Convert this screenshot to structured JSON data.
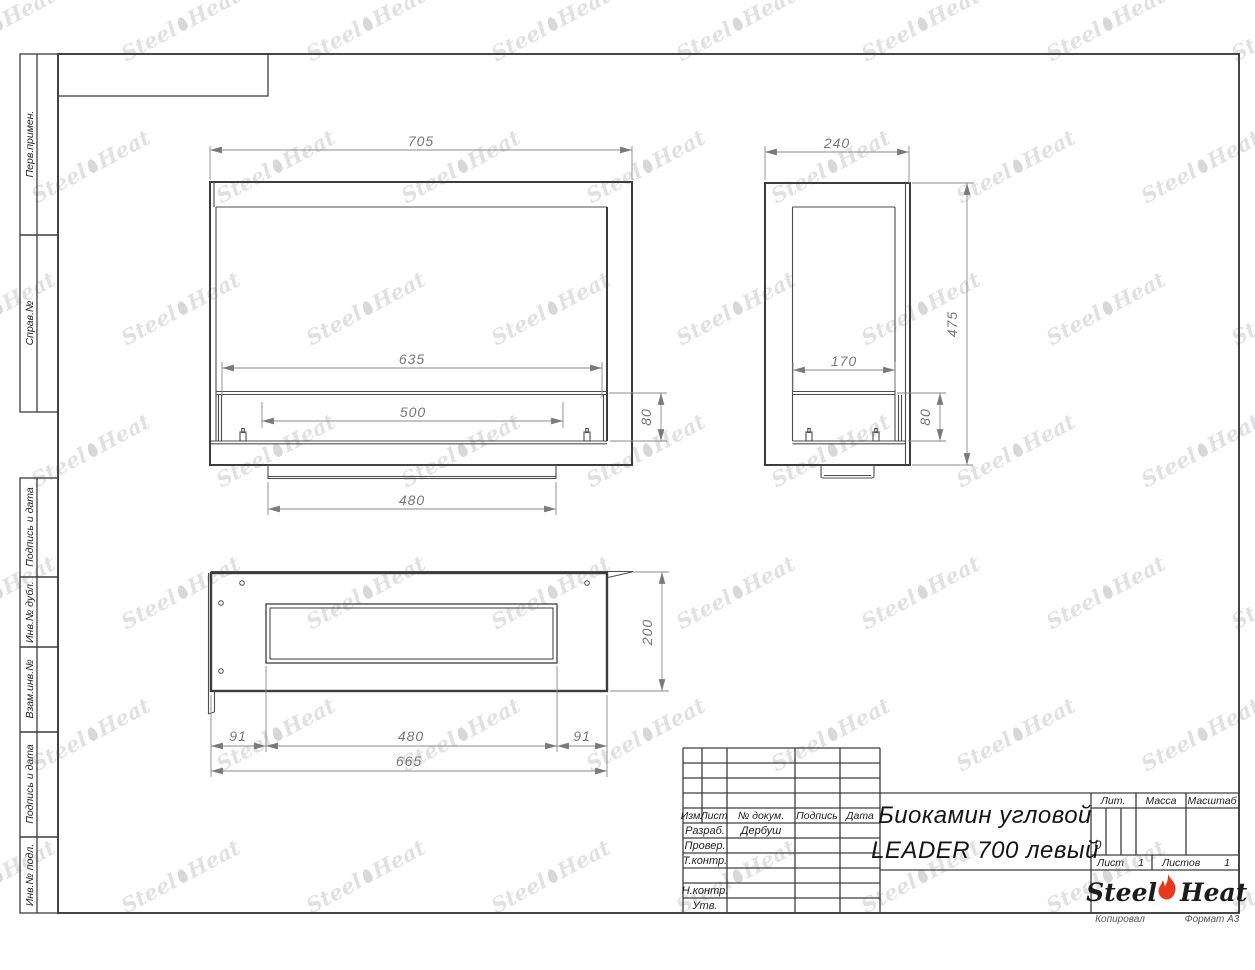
{
  "margin_labels": [
    "Перв.примен.",
    "Справ.№",
    "Подпись и дата",
    "Инв.№ дубл.",
    "Взам.инв.№",
    "Подпись и дата",
    "Инв.№ подл."
  ],
  "title_block": {
    "cols": {
      "izm": "Изм.",
      "list": "Лист",
      "doc": "№ докум.",
      "sign": "Подпись",
      "date": "Дата"
    },
    "rows": {
      "razrab": "Разраб.",
      "prover": "Провер.",
      "tkontr": "Т.контр.",
      "nkontr": "Н.контр.",
      "utv": "Утв."
    },
    "razrab_name": "Дербуш",
    "title_line1": "Биокамин угловой",
    "title_line2": "LEADER 700 левый",
    "lit_label": "Лит.",
    "lit_value": "0",
    "mass_label": "Масса",
    "scale_label": "Масштаб",
    "sheet_label": "Лист",
    "sheet_value": "1",
    "sheets_label": "Листов",
    "sheets_value": "1",
    "brand_left": "Steel",
    "brand_right": "Heat",
    "footer_copy": "Копировал",
    "footer_format": "Формат А3"
  },
  "dims": {
    "front": {
      "width": "705",
      "opening": "635",
      "burner": "500",
      "strip": "80",
      "base": "480"
    },
    "side": {
      "width": "240",
      "height": "475",
      "opening": "170",
      "strip": "80"
    },
    "plan": {
      "depth": "200",
      "left": "91",
      "opening": "480",
      "right": "91",
      "total": "665"
    }
  },
  "watermark": {
    "left": "Steel",
    "right": "Heat"
  },
  "colors": {
    "line": "#3c3c3c",
    "dim": "#8a8a8a",
    "flame": "#e8391f"
  }
}
